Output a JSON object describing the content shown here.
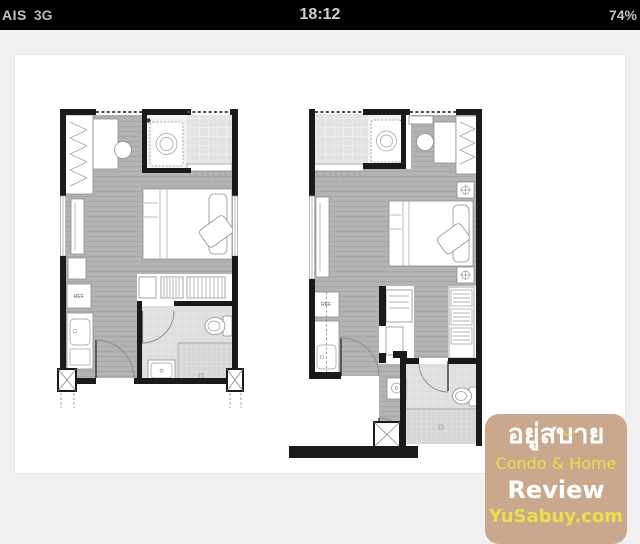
{
  "colors": {
    "statusbar_bg": "#000000",
    "statusbar_fg": "#c2c2c2",
    "viewer_bg": "#f1f1f1",
    "wall": "#1a1a1a",
    "floor": "#b3b3b3",
    "accent_tan": "#c9a88d",
    "accent_yellow": "#e8e04c"
  },
  "status_bar": {
    "carrier": "AIS",
    "network": "3G",
    "time": "18:12",
    "battery": "74%"
  },
  "photo": {
    "description": "Two condo unit floor plans side by side",
    "left_plan": {
      "ref_label": "REF."
    },
    "right_plan": {
      "ref_label": "REF."
    }
  },
  "watermark": {
    "line1_thai": "อยู่สบาย",
    "smiley": "◡",
    "line2": "Condo & Home",
    "line3": "Review",
    "line4": "YuSabuy.com"
  }
}
